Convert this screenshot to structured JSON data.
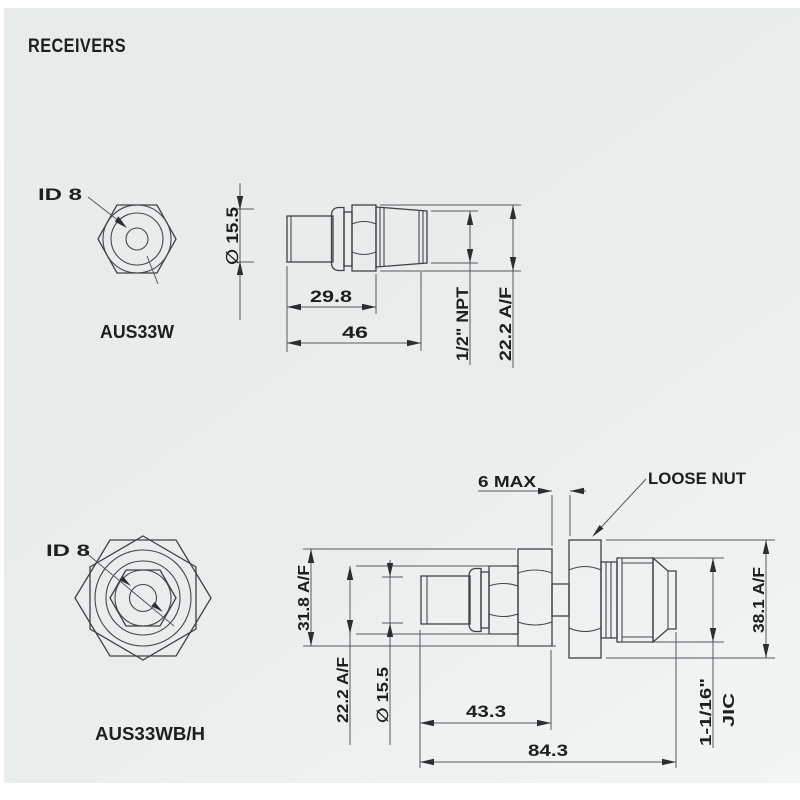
{
  "title": "RECEIVERS",
  "colors": {
    "background": "#e9edec",
    "line": "#42474a",
    "text": "#1b1f1e"
  },
  "aus33w": {
    "name": "AUS33W",
    "bore": "ID 8",
    "dims": {
      "diameter": "∅ 15.5",
      "body_length": "29.8",
      "overall_length": "46",
      "thread": "1/2\" NPT",
      "hex": "22.2 A/F"
    }
  },
  "aus33wbh": {
    "name": "AUS33WB/H",
    "bore": "ID 8",
    "loose_nut": "LOOSE NUT",
    "dims": {
      "panel_max": "6 MAX",
      "body_hex": "31.8 A/F",
      "hex": "22.2 A/F",
      "diameter": "∅ 15.5",
      "body_length": "43.3",
      "overall_length": "84.3",
      "thread_size": "1-1/16\"",
      "thread_type": "JIC",
      "nut_hex": "38.1 A/F"
    }
  }
}
